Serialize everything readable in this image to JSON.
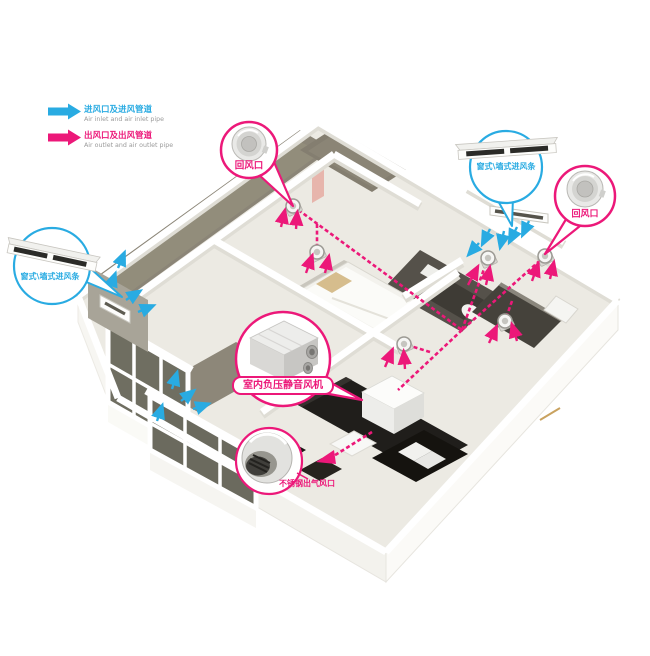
{
  "colors": {
    "inlet_blue": "#29abe2",
    "outlet_pink": "#ec1879"
  },
  "legend": {
    "items": [
      {
        "zh": "进风口及进风管道",
        "en": "Air inlet and air inlet pipe",
        "color": "#29abe2"
      },
      {
        "zh": "出风口及出风管道",
        "en": "Air outlet and air outlet pipe",
        "color": "#ec1879"
      }
    ]
  },
  "callouts": {
    "return_air_top": {
      "label": "回风口"
    },
    "window_wall_inlet_right": {
      "label": "窗式\\墙式进风条"
    },
    "return_air_right": {
      "label": "回风口"
    },
    "window_wall_inlet_left": {
      "label": "窗式\\墙式进风条"
    },
    "indoor_fan": {
      "label": "室内负压静音风机"
    },
    "steel_outlet": {
      "label": "不锈钢出气风口"
    }
  }
}
